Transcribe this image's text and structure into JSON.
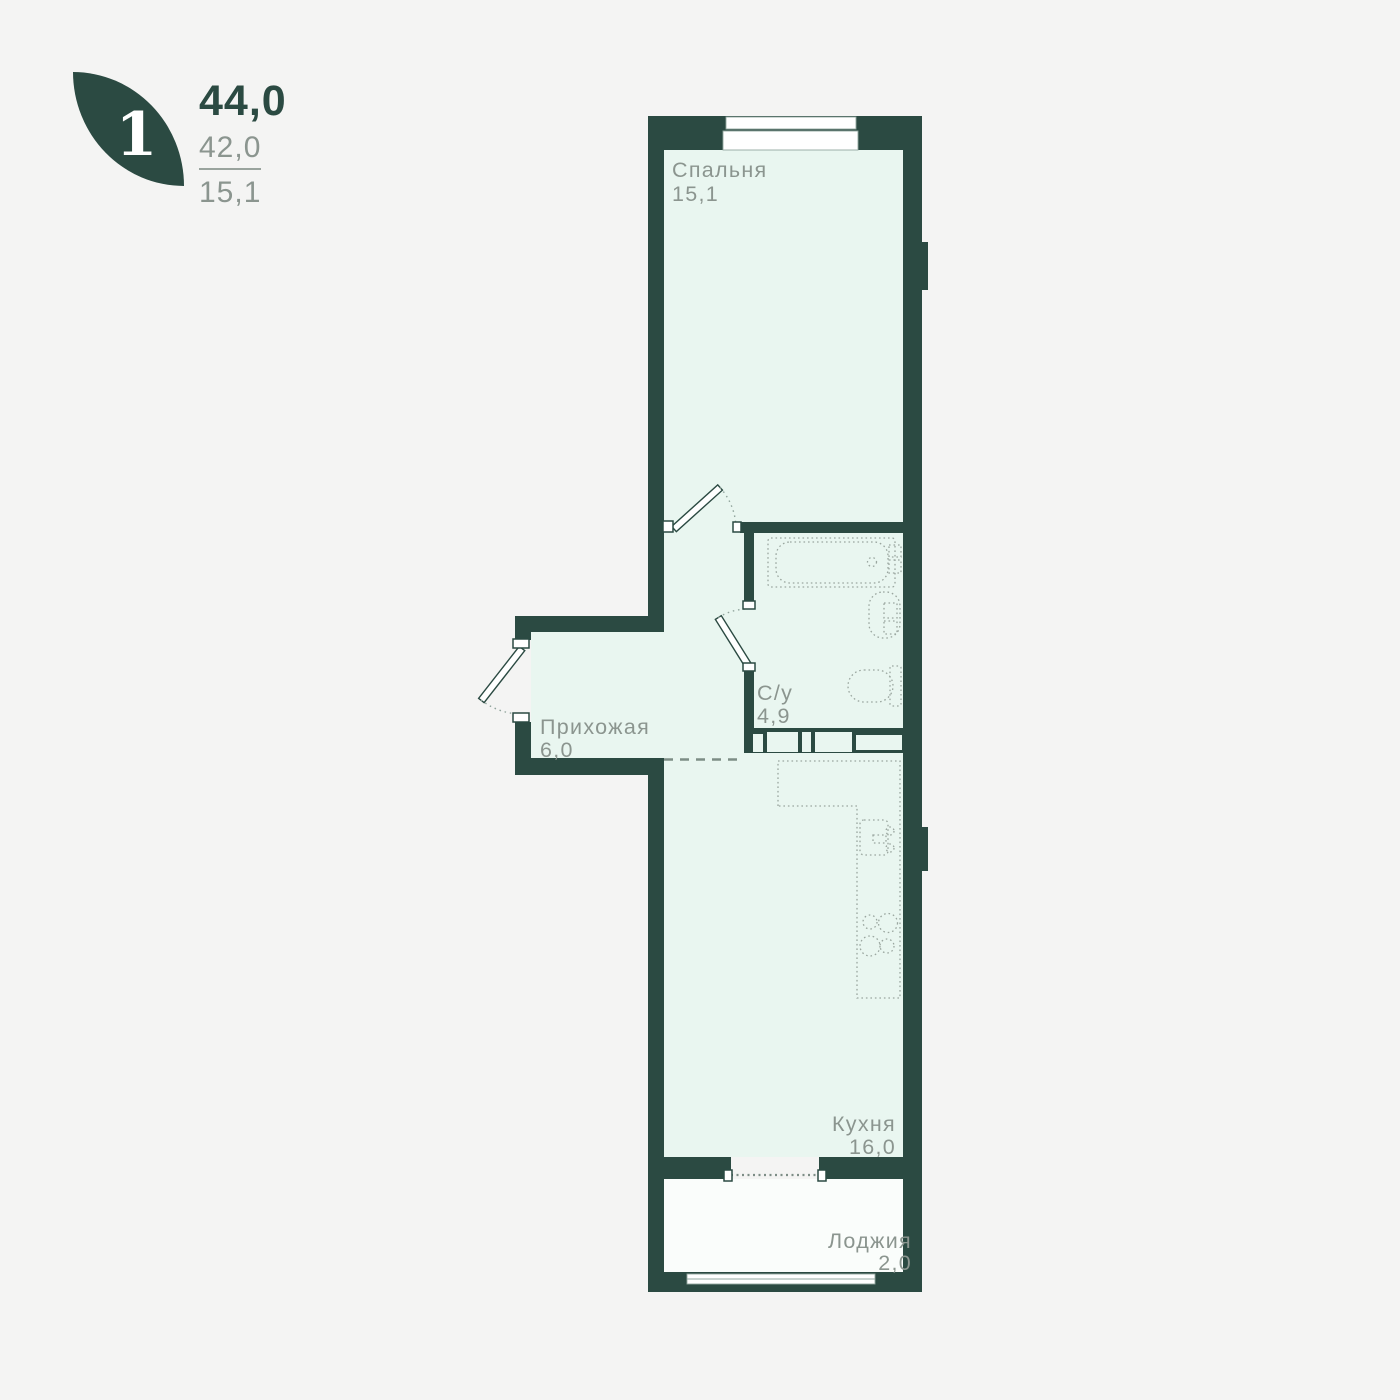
{
  "header": {
    "rooms_badge": "1",
    "total_area": "44,0",
    "area_living": "42,0",
    "area_room": "15,1"
  },
  "rooms": [
    {
      "name": "Спальня",
      "area": "15,1"
    },
    {
      "name": "С/у",
      "area": "4,9"
    },
    {
      "name": "Прихожая",
      "area": "6,0"
    },
    {
      "name": "Кухня",
      "area": "16,0"
    },
    {
      "name": "Лоджия",
      "area": "2,0"
    }
  ],
  "colors": {
    "wall": "#2b4a42",
    "room_fill": "#e9f6f0",
    "loggia_fill": "#fafdfb",
    "background": "#f4f4f3",
    "label": "#8b958f",
    "fixture": "#9aa69f"
  }
}
